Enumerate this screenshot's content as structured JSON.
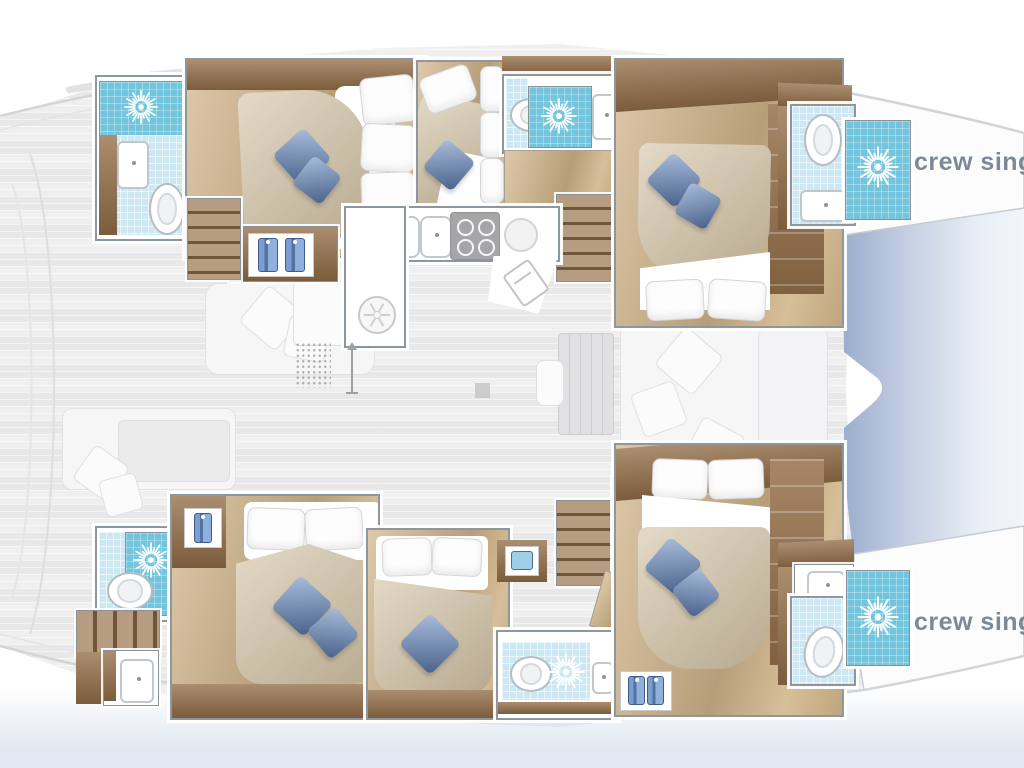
{
  "labels": {
    "crew_single_top": "crew single",
    "crew_single_bottom": "crew single"
  },
  "plan": {
    "vessel_type": "catamaran",
    "view": "top-down interior deck plan",
    "hulls": 2,
    "double_cabins": 6,
    "crew_single_cabins": 2,
    "bathrooms_with_shower": 6,
    "galley": "U-shaped galley on center bridge deck",
    "saloon": "center saloon with table and lounge",
    "stair_flights": 4
  },
  "icons": {
    "shower": "sunburst-shower-icon",
    "toilet": "toilet-icon",
    "sink": "sink-icon",
    "stove": "stove-burners-icon",
    "fridge": "fridge-icon",
    "washer": "washer-icon",
    "wardrobe": "hanging-towel-icon",
    "heading": "up-arrow-icon"
  },
  "colors": {
    "shower-blue": "#72c5dd",
    "tile-blue": "#cde8f3",
    "wood-dark": "#96714b",
    "wood-light": "#d0b489",
    "duvet": "#d3c3a5",
    "pillow-blue": "#6487bf",
    "label-gray": "#7d8996",
    "outline": "#8f979e",
    "water-blue": "#98abcc"
  }
}
